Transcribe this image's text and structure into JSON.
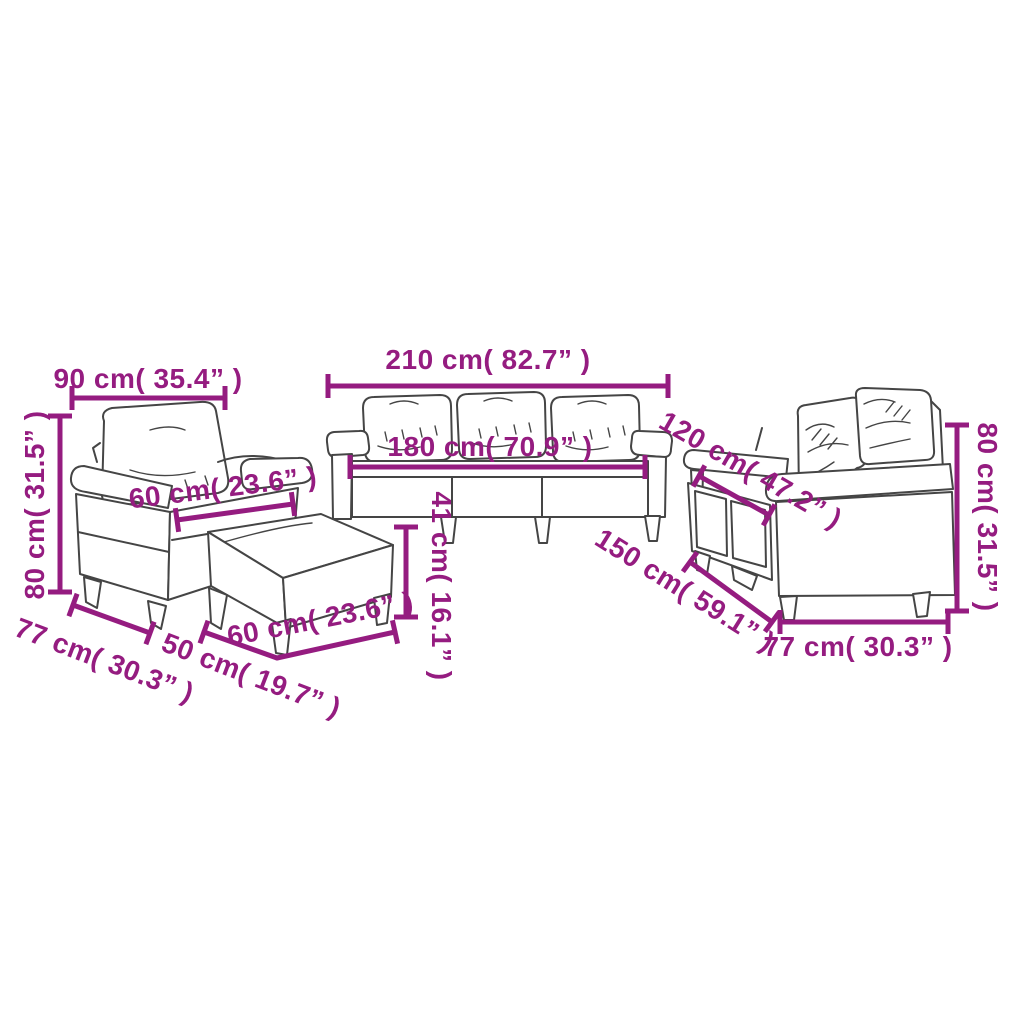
{
  "colors": {
    "annotation": "#951C80",
    "line_art": "#454545",
    "background": "#FFFFFF"
  },
  "dimensions": {
    "armchair": {
      "width": "90 cm( 35.4” )",
      "height": "80 cm( 31.5” )",
      "seat_width": "60 cm( 23.6” )",
      "depth": "77 cm( 30.3” )"
    },
    "sofa_3_seater": {
      "width": "210 cm( 82.7” )",
      "seat_width": "180 cm( 70.9” )"
    },
    "ottoman": {
      "height": "41 cm( 16.1” )",
      "depth": "50 cm( 19.7” )",
      "width": "60 cm( 23.6” )"
    },
    "sofa_2_seater": {
      "seat_width": "120 cm( 47.2” )",
      "width": "150 cm( 59.1” )",
      "height": "80 cm( 31.5” )",
      "depth": "77 cm( 30.3” )"
    }
  }
}
